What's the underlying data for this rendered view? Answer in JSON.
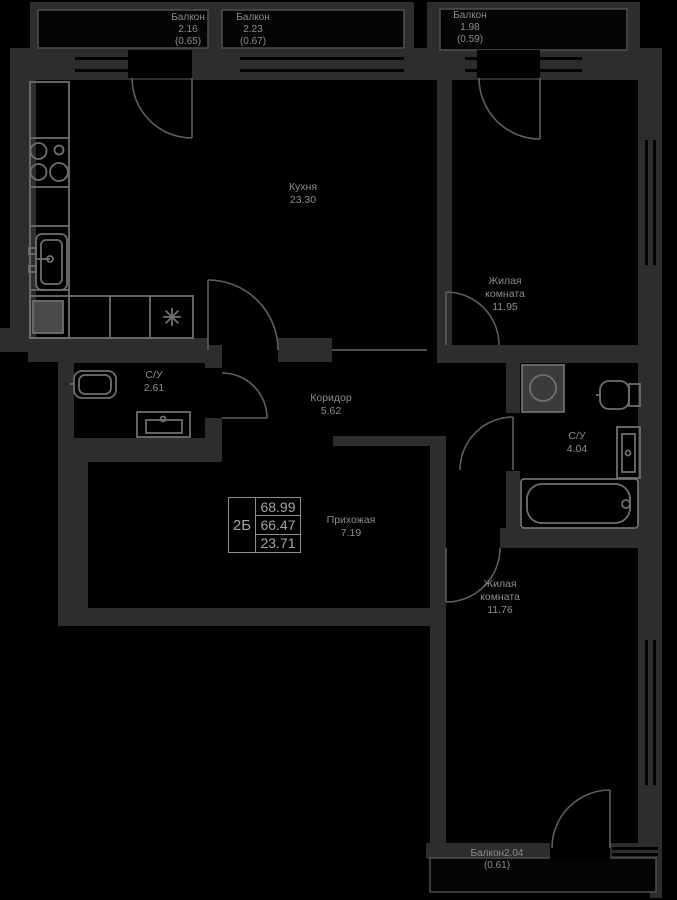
{
  "plan": {
    "stat": {
      "type": "2Б",
      "values": [
        "68.99",
        "66.47",
        "23.71"
      ]
    },
    "rooms": {
      "kitchen": {
        "name": "Кухня",
        "area": "23.30"
      },
      "living1": {
        "line1": "Жилая",
        "line2": "комната",
        "area": "11.95"
      },
      "wc1": {
        "name": "С/У",
        "area": "2.61"
      },
      "corridor": {
        "name": "Коридор",
        "area": "5.62"
      },
      "wc2": {
        "name": "С/У",
        "area": "4.04"
      },
      "hall": {
        "name": "Прихожая",
        "area": "7.19"
      },
      "living2": {
        "line1": "Жилая",
        "line2": "комната",
        "area": "11.76"
      }
    },
    "balconies": {
      "top_left": {
        "name": "Балкон",
        "area": "2.16",
        "reduced": "(0.65)"
      },
      "top_mid": {
        "name": "Балкон",
        "area": "2.23",
        "reduced": "(0.67)"
      },
      "top_right": {
        "name": "Балкон",
        "area": "1.98",
        "reduced": "(0.59)"
      },
      "bottom": {
        "name": "Балкон",
        "area": "2.04",
        "reduced": "(0.61)"
      }
    },
    "colors": {
      "wall": "#2d2d2d",
      "background": "#000000",
      "fixture_line": "#6f6f6f",
      "text": "#8c8c8c"
    }
  }
}
